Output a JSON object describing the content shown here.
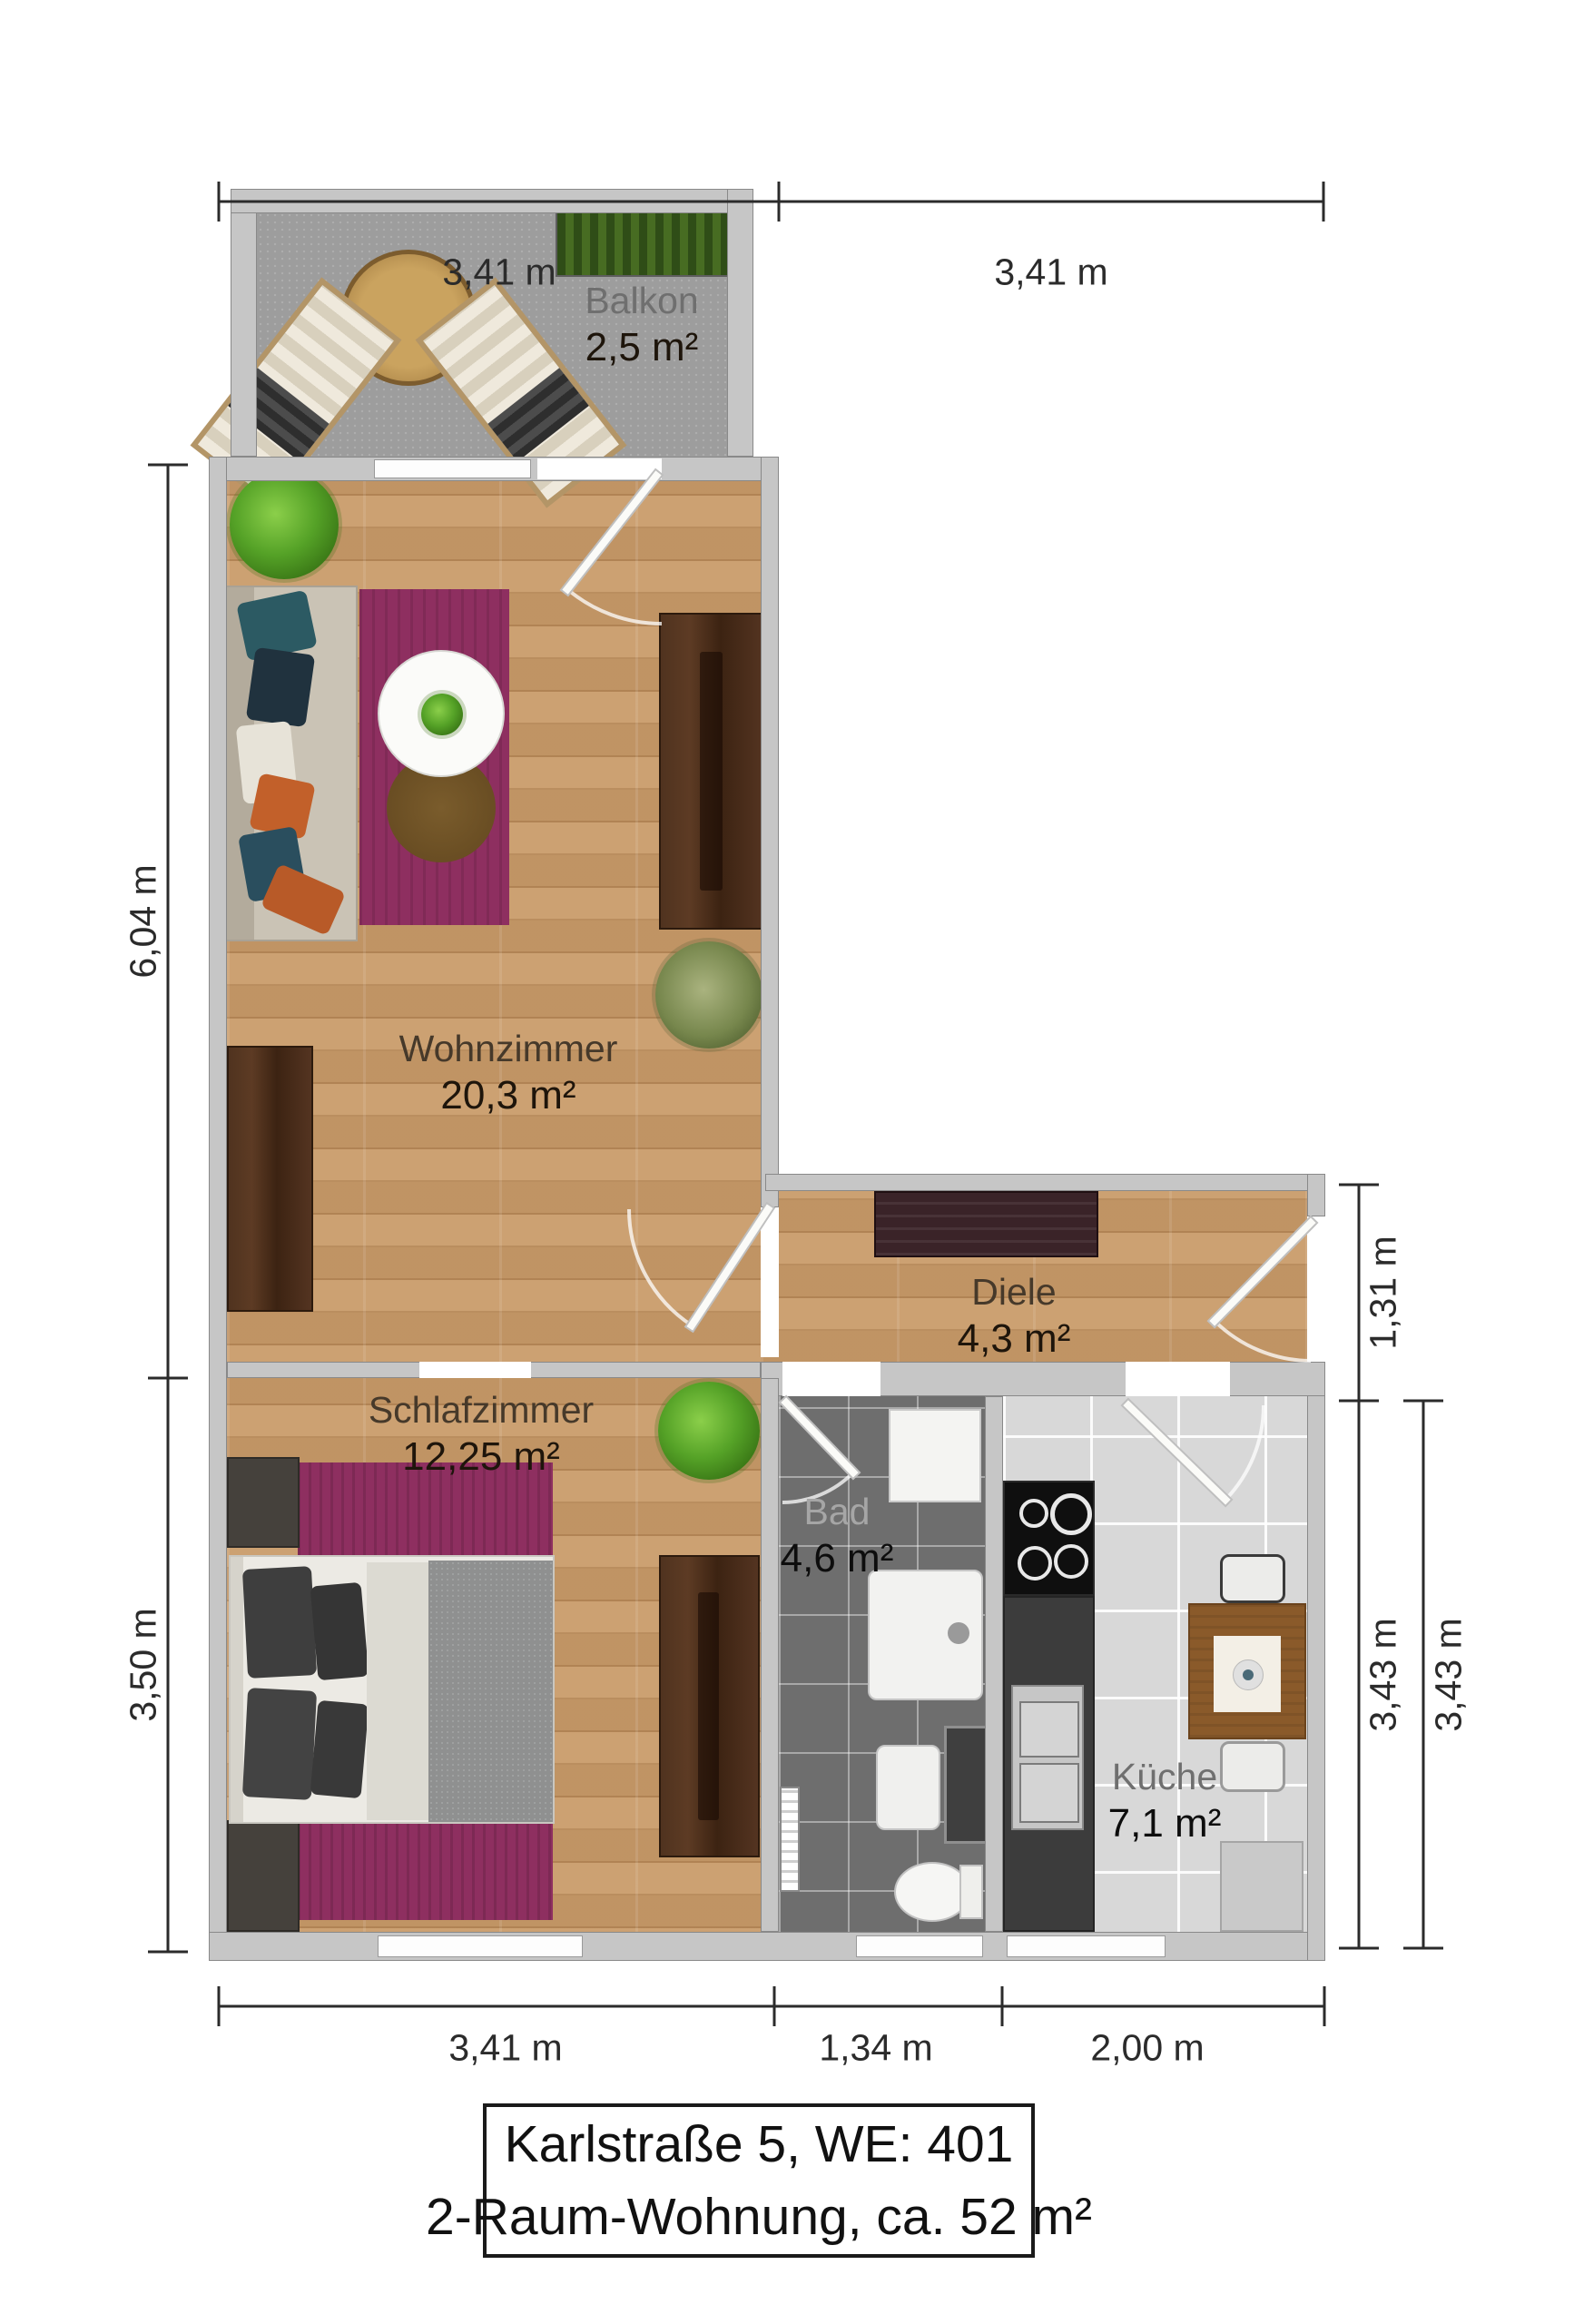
{
  "title_box": {
    "line1": "Karlstraße 5, WE: 401",
    "line2": "2-Raum-Wohnung, ca. 52 m²"
  },
  "rooms": {
    "balkon": {
      "name": "Balkon",
      "area": "2,5 m²"
    },
    "wohnzimmer": {
      "name": "Wohnzimmer",
      "area": "20,3 m²"
    },
    "diele": {
      "name": "Diele",
      "area": "4,3 m²"
    },
    "schlafzimmer": {
      "name": "Schlafzimmer",
      "area": "12,25 m²"
    },
    "bad": {
      "name": "Bad",
      "area": "4,6 m²"
    },
    "kueche": {
      "name": "Küche",
      "area": "7,1 m²"
    }
  },
  "dimensions": {
    "top": [
      "3,41 m",
      "3,41 m"
    ],
    "bottom": [
      "3,41 m",
      "1,34 m",
      "2,00 m"
    ],
    "left": [
      "6,04 m",
      "3,50 m"
    ],
    "right": [
      "1,31 m",
      "3,43 m",
      "3,43 m"
    ]
  },
  "colors": {
    "wall": "#c6c6c6",
    "wood_floor": "#c69a6b",
    "balcony_floor": "#9d9d9d",
    "bad_floor": "#6e6e6e",
    "kueche_floor": "#d8d8d8",
    "rug_purple": "#8e2f60",
    "dark_wood": "#4a2d1b",
    "dimension_line": "#2b2b2b",
    "plant_green": "#55a227",
    "door_leaf": "#fbfbf8"
  }
}
